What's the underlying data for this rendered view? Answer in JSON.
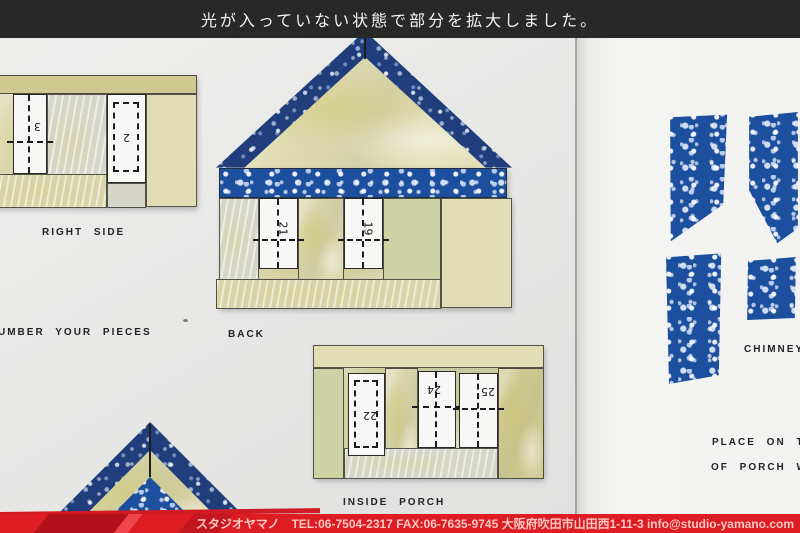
{
  "top_banner": {
    "text": "光が入っていない状態で部分を拡大しました。",
    "bg": "#282828"
  },
  "bottom_banner": {
    "text": "スタジオヤマノ　TEL:06-7504-2317 FAX:06-7635-9745 大阪府吹田市山田西1-11-3 info@studio-yamano.com",
    "bg": "#dd1c24"
  },
  "labels": {
    "right_side": "RIGHT SIDE",
    "number_pieces": "UMBER YOUR PIECES",
    "back": "BACK",
    "inside_porch": "INSIDE PORCH",
    "chimney": "CHIMNEY",
    "place_line1": "PLACE ON TO",
    "place_line2": "OF PORCH W"
  },
  "piece_numbers": {
    "right_side_window1": "3",
    "right_side_window2": "2",
    "back_window1": "21",
    "back_window2": "19",
    "porch_door": "22",
    "porch_window1": "24",
    "porch_window2": "25"
  },
  "colors": {
    "blue_glass": "#1c4f9e",
    "navy_glass": "#203e7c",
    "yellow_glass": "#d8d5a9",
    "red_banner": "#dd1c24",
    "black_banner": "#282828",
    "paper_left": "#e8e8e7",
    "paper_right": "#f3f3f1"
  }
}
